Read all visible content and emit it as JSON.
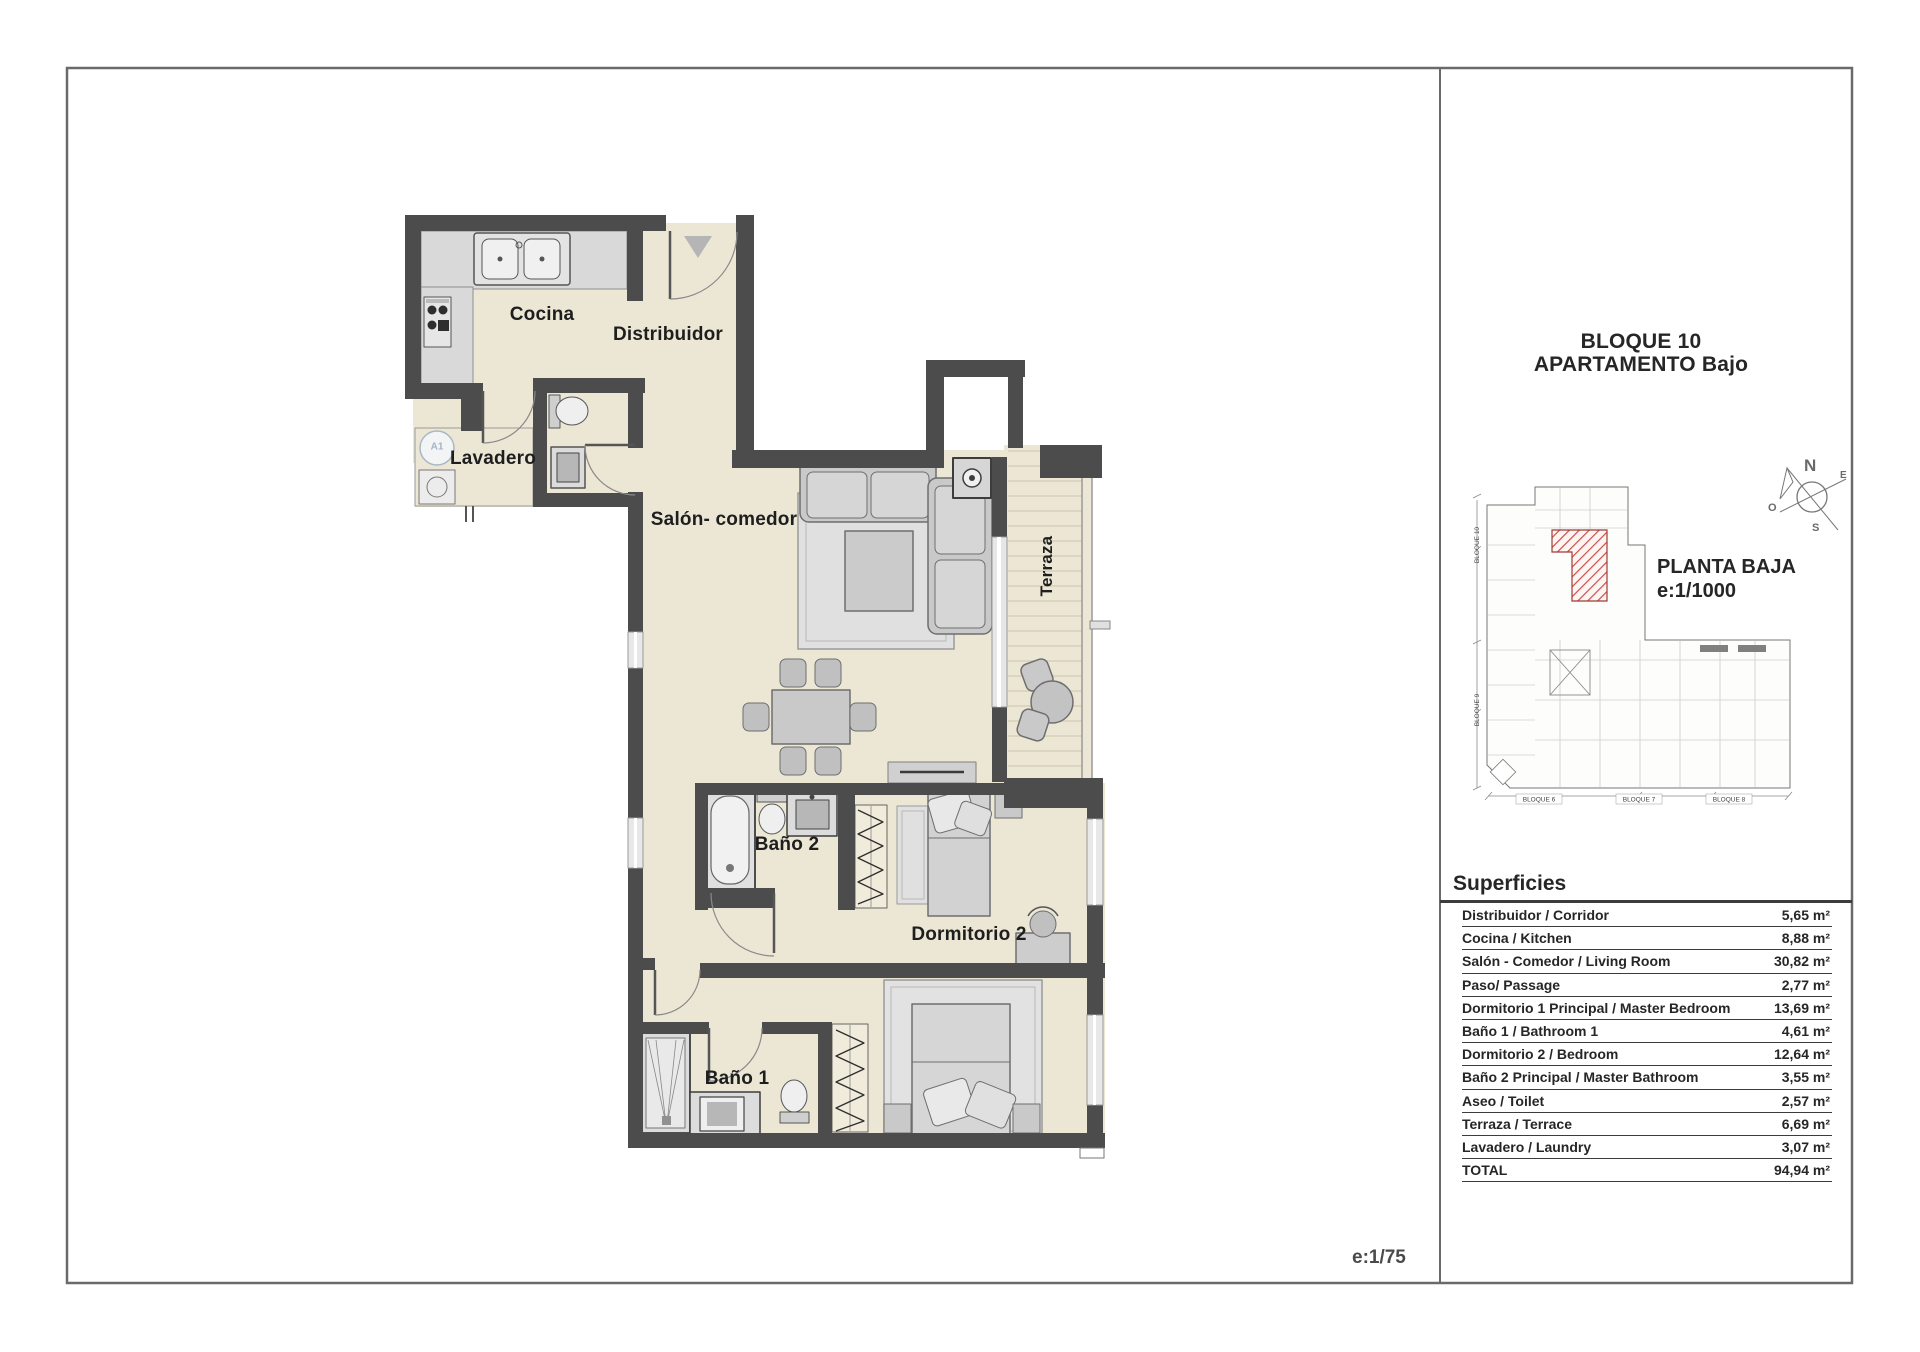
{
  "sheet": {
    "scale_label": "e:1/75"
  },
  "plan": {
    "rooms": {
      "cocina": "Cocina",
      "distribuidor": "Distribuidor",
      "lavadero": "Lavadero",
      "salon_comedor": "Salón- comedor",
      "terraza": "Terraza",
      "bano2": "Baño 2",
      "dormitorio2": "Dormitorio 2",
      "bano1": "Baño 1"
    },
    "symbols": {
      "laundry_circle": "A1"
    }
  },
  "panel": {
    "title_line1": "BLOQUE 10",
    "title_line2": "APARTAMENTO Bajo",
    "site_plan": {
      "name": "PLANTA BAJA",
      "scale": "e:1/1000",
      "block_labels_bottom": [
        "BLOQUE 6",
        "BLOQUE 7",
        "BLOQUE 8"
      ],
      "block_labels_left": [
        "BLOQUE 10",
        "BLOQUE 9"
      ]
    },
    "compass": {
      "n": "N",
      "e": "E",
      "s": "S",
      "o": "O"
    },
    "superficies": {
      "heading": "Superficies",
      "rows": [
        {
          "name": "Distribuidor / Corridor",
          "value": "5,65 m²"
        },
        {
          "name": "Cocina / Kitchen",
          "value": "8,88 m²"
        },
        {
          "name": "Salón - Comedor / Living Room",
          "value": "30,82 m²"
        },
        {
          "name": "Paso/ Passage",
          "value": "2,77 m²"
        },
        {
          "name": "Dormitorio 1 Principal / Master Bedroom",
          "value": "13,69 m²"
        },
        {
          "name": "Baño 1 / Bathroom 1",
          "value": "4,61 m²"
        },
        {
          "name": "Dormitorio 2 / Bedroom",
          "value": "12,64 m²"
        },
        {
          "name": "Baño 2 Principal / Master Bathroom",
          "value": "3,55 m²"
        },
        {
          "name": "Aseo / Toilet",
          "value": "2,57 m²"
        },
        {
          "name": "Terraza / Terrace",
          "value": "6,69 m²"
        },
        {
          "name": "Lavadero / Laundry",
          "value": "3,07 m²"
        },
        {
          "name": "TOTAL",
          "value": "94,94 m²"
        }
      ]
    }
  },
  "colors": {
    "wall": "#4c4c4c",
    "floor": "#ece7d5",
    "counter": "#d9d9d9",
    "furniture": "#c9c9c9",
    "highlight_red": "#c0453c",
    "frame": "#6a6a6a"
  }
}
